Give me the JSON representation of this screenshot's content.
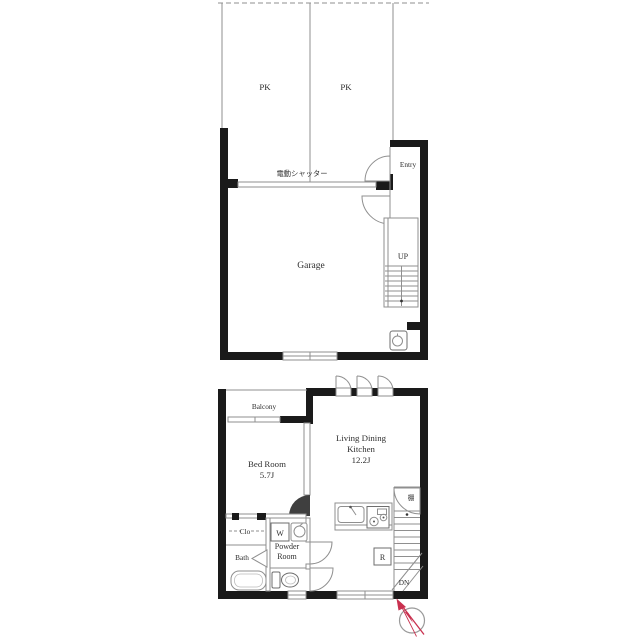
{
  "document_type": "floor-plan",
  "first_floor": {
    "parking_left_label": "PK",
    "parking_right_label": "PK",
    "shutter_label": "電動シャッター",
    "entry_label": "Entry",
    "garage_label": "Garage",
    "stairs_label": "UP"
  },
  "second_floor": {
    "balcony_label": "Balcony",
    "bedroom_label_line1": "Bed Room",
    "bedroom_label_line2": "5.7J",
    "ldk_label_line1": "Living Dining",
    "ldk_label_line2": "Kitchen",
    "ldk_label_line3": "12.2J",
    "closet_label": "Clo",
    "washer_label": "W",
    "powder_label_line1": "Powder",
    "powder_label_line2": "Room",
    "bath_label": "Bath",
    "fridge_label": "R",
    "stairs_label": "DN",
    "shelf_label": "棚"
  },
  "colors": {
    "wall": "#1a1a1a",
    "thin_line": "#8f8f8f",
    "text": "#2e2e2e",
    "compass_red": "#c9314f",
    "background": "#ffffff"
  }
}
